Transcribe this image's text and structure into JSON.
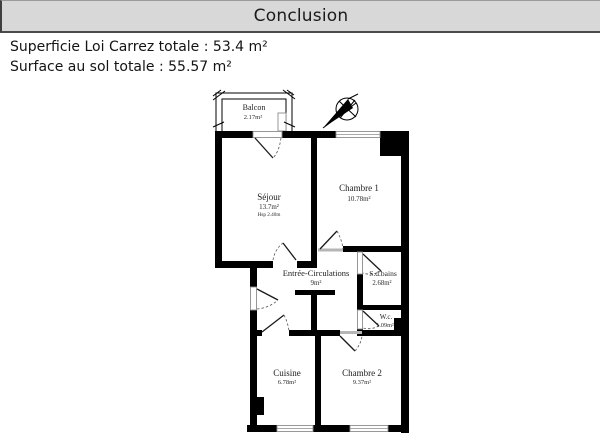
{
  "page": {
    "title": "Conclusion"
  },
  "summary": {
    "lines": [
      "Superficie Loi Carrez totale : 53.4 m²",
      "Surface au sol totale : 55.57 m²"
    ]
  },
  "floorplan": {
    "rooms": {
      "balcon": {
        "name": "Balcon",
        "area": "2.17m²"
      },
      "sejour": {
        "name": "Séjour",
        "area": "13.7m²",
        "note": "Hsp 2.40m"
      },
      "chambre1": {
        "name": "Chambre 1",
        "area": "10.78m²"
      },
      "entree": {
        "name": "Entrée-Circulations",
        "area": "9m²"
      },
      "sdb": {
        "name": "S.d.bains",
        "area": "2.68m²"
      },
      "wc": {
        "name": "W.c.",
        "area": "1.09m²"
      },
      "cuisine": {
        "name": "Cuisine",
        "area": "6.78m²"
      },
      "chambre2": {
        "name": "Chambre 2",
        "area": "9.37m²"
      }
    },
    "icons": {
      "compass": "north-arrow"
    }
  },
  "colors": {
    "header_bg": "#d8d8d8",
    "header_rule": "#4a4a4a",
    "wall": "#000000",
    "text": "#141414"
  }
}
